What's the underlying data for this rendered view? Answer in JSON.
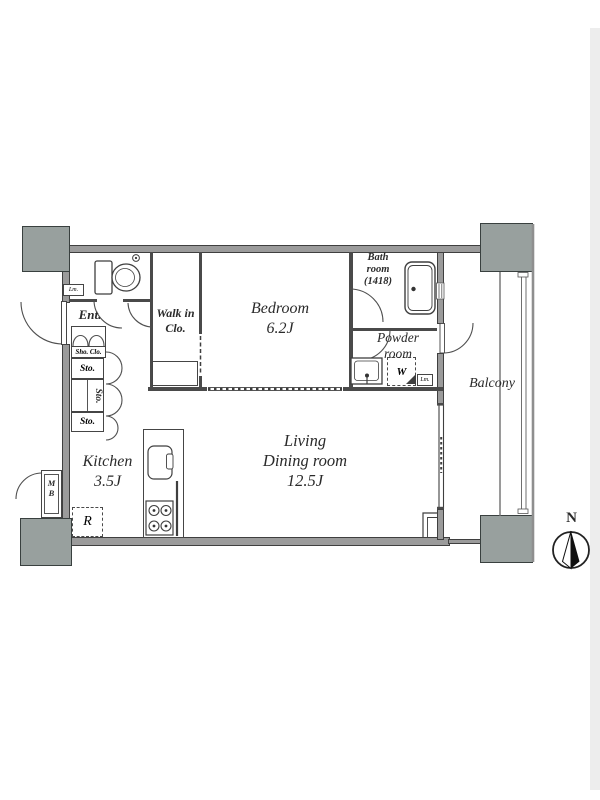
{
  "rooms": {
    "bedroom": {
      "name": "Bedroom",
      "size": "6.2J"
    },
    "living_dining": {
      "line1": "Living",
      "line2": "Dining room",
      "size": "12.5J"
    },
    "kitchen": {
      "name": "Kitchen",
      "size": "3.5J"
    },
    "walk_in_closet": {
      "line1": "Walk in",
      "line2": "Clo."
    },
    "bathroom": {
      "line1": "Bath",
      "line2": "room",
      "line3": "(1418)"
    },
    "powder_room": {
      "line1": "Powder",
      "line2": "room"
    },
    "entrance": {
      "name": "Ent."
    },
    "balcony": {
      "name": "Balcony"
    }
  },
  "storage": {
    "shoe_closet": "Sho. Clo.",
    "storage1": "Sto.",
    "storage2": "Sto.",
    "storage3": "Sto."
  },
  "fixtures": {
    "washing_machine": "W",
    "refrigerator": "R",
    "meter_box": {
      "line1": "M",
      "line2": "B"
    },
    "linen_entrance": "Lm.",
    "linen_powder": "Lm."
  },
  "compass": {
    "north": "N"
  },
  "colors": {
    "wall": "#9b9b9b",
    "pillar": "#98a09e",
    "line": "#4a4a4a",
    "text": "#2a2a2a",
    "edge_band": "#ededed"
  }
}
